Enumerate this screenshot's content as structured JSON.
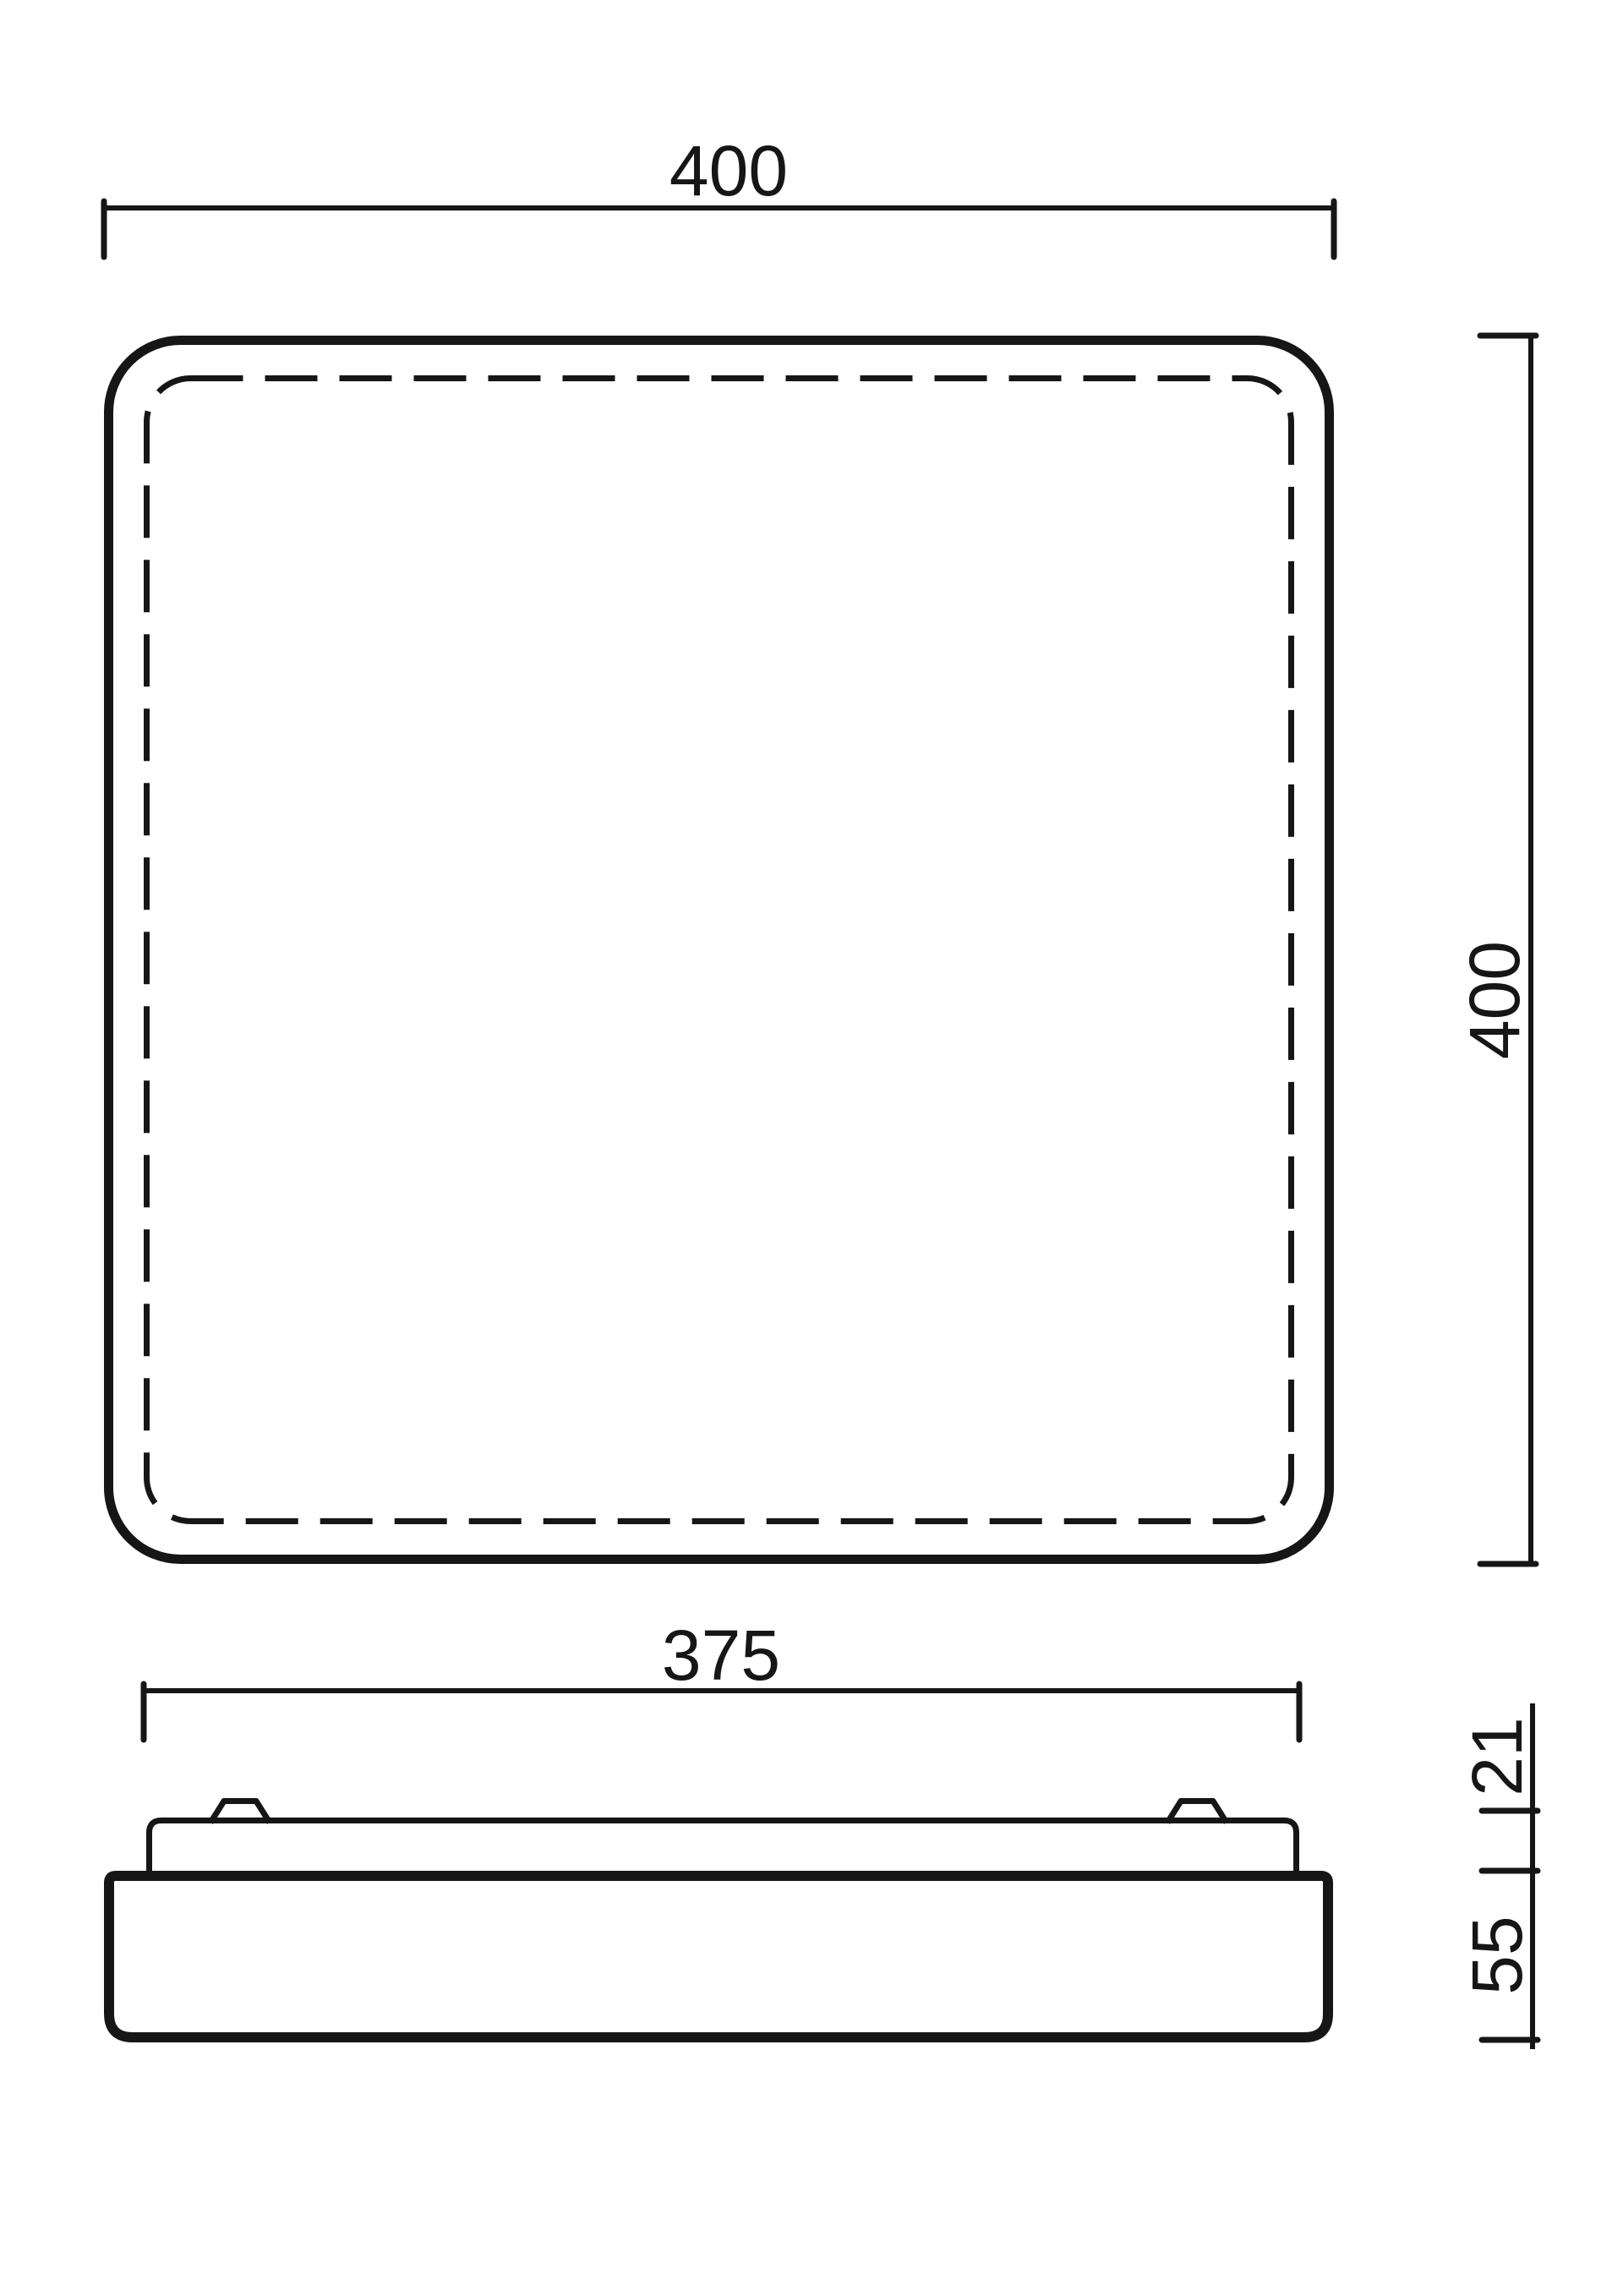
{
  "page": {
    "background": "#ffffff",
    "line_color": "#161616"
  },
  "drawing": {
    "dimension_labels": {
      "top_view_width": "400",
      "top_view_height": "400",
      "side_view_diffuser_width": "375",
      "side_view_diffuser_height": "21",
      "side_view_base_height": "55"
    }
  }
}
